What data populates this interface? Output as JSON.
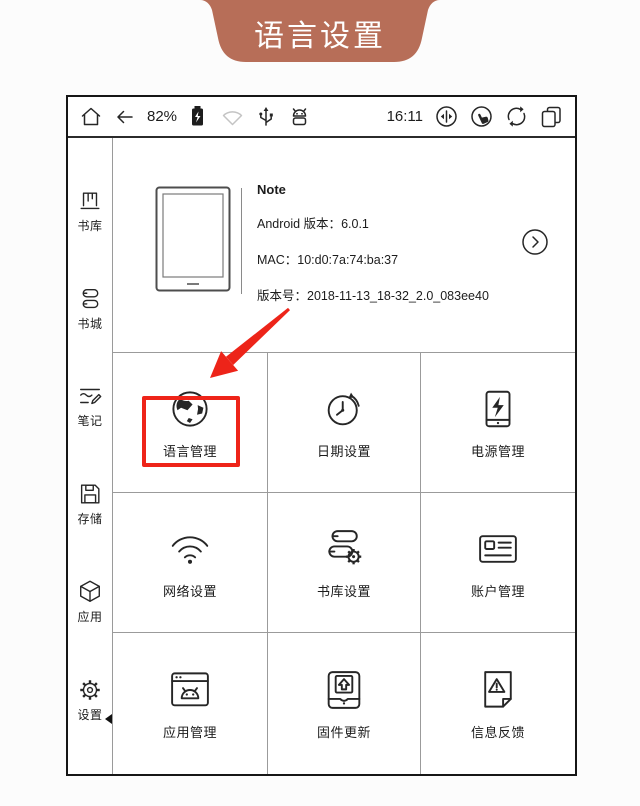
{
  "banner": {
    "title": "语言设置",
    "bg_color": "#b76e58",
    "text_color": "#ffffff"
  },
  "status_bar": {
    "battery_percent": "82%",
    "time": "16:11",
    "left_icons": [
      "home-icon",
      "back-arrow-icon",
      "battery-icon",
      "wifi-icon",
      "usb-icon",
      "android-icon"
    ],
    "right_icons": [
      "a2-refresh-mode-icon",
      "touch-mode-icon",
      "sync-refresh-icon",
      "pages-icon"
    ]
  },
  "sidebar": {
    "items": [
      {
        "label": "书库",
        "icon": "library-icon",
        "selected": false
      },
      {
        "label": "书城",
        "icon": "bookstore-icon",
        "selected": false
      },
      {
        "label": "笔记",
        "icon": "notes-icon",
        "selected": false
      },
      {
        "label": "存储",
        "icon": "storage-icon",
        "selected": false
      },
      {
        "label": "应用",
        "icon": "apps-icon",
        "selected": false
      },
      {
        "label": "设置",
        "icon": "settings-icon",
        "selected": true
      }
    ]
  },
  "device_info": {
    "name": "Note",
    "android_label": "Android 版本：",
    "android_version": "6.0.1",
    "mac_label": "MAC：",
    "mac_value": "10:d0:7a:74:ba:37",
    "build_label": "版本号：",
    "build_value": "2018-11-13_18-32_2.0_083ee40"
  },
  "grid": {
    "items": [
      {
        "label": "语言管理",
        "icon": "language-globe-icon",
        "highlighted": true
      },
      {
        "label": "日期设置",
        "icon": "date-clock-icon",
        "highlighted": false
      },
      {
        "label": "电源管理",
        "icon": "power-battery-icon",
        "highlighted": false
      },
      {
        "label": "网络设置",
        "icon": "network-wifi-icon",
        "highlighted": false
      },
      {
        "label": "书库设置",
        "icon": "library-gear-icon",
        "highlighted": false
      },
      {
        "label": "账户管理",
        "icon": "account-card-icon",
        "highlighted": false
      },
      {
        "label": "应用管理",
        "icon": "app-window-icon",
        "highlighted": false
      },
      {
        "label": "固件更新",
        "icon": "firmware-update-icon",
        "highlighted": false
      },
      {
        "label": "信息反馈",
        "icon": "feedback-doc-icon",
        "highlighted": false
      }
    ]
  },
  "annotation": {
    "highlight_color": "#ee2419"
  }
}
